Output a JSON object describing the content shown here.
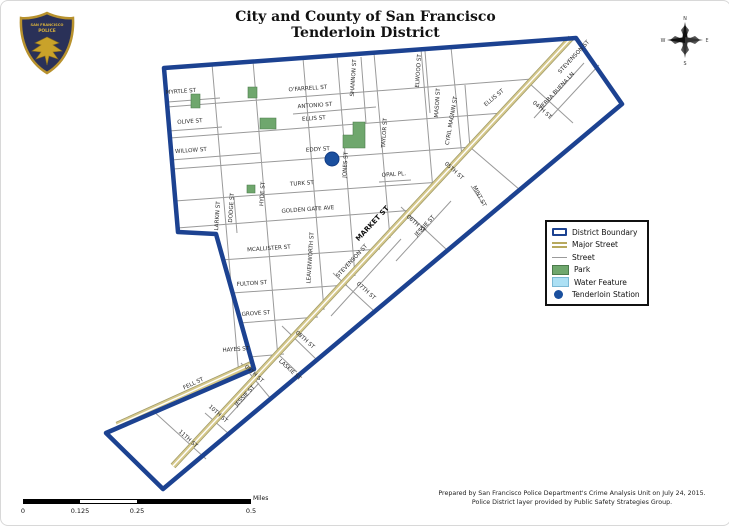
{
  "title": {
    "line1": "City and County of San Francisco",
    "line2": "Tenderloin District"
  },
  "badge": {
    "arc_top": "SAN FRANCISCO",
    "arc_middle": "POLICE"
  },
  "compass": {
    "n": "N",
    "e": "E",
    "s": "S",
    "w": "W"
  },
  "legend": {
    "items": [
      {
        "label": "District Boundary",
        "symbol": "district-boundary"
      },
      {
        "label": "Major Street",
        "symbol": "major-street"
      },
      {
        "label": "Street",
        "symbol": "street"
      },
      {
        "label": "Park",
        "symbol": "park"
      },
      {
        "label": "Water Feature",
        "symbol": "water-feature"
      },
      {
        "label": "Tenderloin Station",
        "symbol": "station-dot"
      }
    ]
  },
  "scale_bar": {
    "tick_labels": [
      "0",
      "0.125",
      "0.25",
      "0.5"
    ],
    "unit_label": "Miles"
  },
  "attribution": {
    "line1": "Prepared by San Francisco Police Department's Crime Analysis Unit on July 24, 2015.",
    "line2": "Police District layer provided by Public Safety Strategies Group."
  },
  "colors": {
    "boundary": "#1c4291",
    "major_street": "#d6c98c",
    "street": "#9a9a9a",
    "park": "#6fa76d",
    "water": "#ace0f4",
    "station": "#1a4f9e"
  },
  "map": {
    "street_labels": [
      {
        "t": "MYRTLE ST",
        "x": 180,
        "y": 92,
        "r": -4
      },
      {
        "t": "OLIVE ST",
        "x": 189,
        "y": 122,
        "r": -4
      },
      {
        "t": "WILLOW ST",
        "x": 190,
        "y": 151,
        "r": -4
      },
      {
        "t": "O'FARRELL ST",
        "x": 307,
        "y": 89,
        "r": -4
      },
      {
        "t": "ANTONIO ST",
        "x": 314,
        "y": 106,
        "r": -4
      },
      {
        "t": "ELLIS ST",
        "x": 313,
        "y": 119,
        "r": -4
      },
      {
        "t": "EDDY ST",
        "x": 317,
        "y": 150,
        "r": -4
      },
      {
        "t": "TURK ST",
        "x": 301,
        "y": 184,
        "r": -4
      },
      {
        "t": "OPAL PL.",
        "x": 393,
        "y": 175,
        "r": -4
      },
      {
        "t": "GOLDEN GATE AVE",
        "x": 307,
        "y": 210,
        "r": -4
      },
      {
        "t": "MCALLISTER ST",
        "x": 268,
        "y": 249,
        "r": -4
      },
      {
        "t": "FULTON ST",
        "x": 251,
        "y": 284,
        "r": -4
      },
      {
        "t": "GROVE ST",
        "x": 255,
        "y": 314,
        "r": -4
      },
      {
        "t": "HAYES ST",
        "x": 235,
        "y": 350,
        "r": -4
      },
      {
        "t": "ELLIS ST",
        "x": 494,
        "y": 98,
        "r": -40
      },
      {
        "t": "LARKIN ST",
        "x": 218,
        "y": 215,
        "r": -86
      },
      {
        "t": "DODGE ST",
        "x": 232,
        "y": 207,
        "r": -86
      },
      {
        "t": "HYDE ST",
        "x": 263,
        "y": 193,
        "r": -86
      },
      {
        "t": "LEAVENWORTH ST",
        "x": 311,
        "y": 257,
        "r": -86
      },
      {
        "t": "JONES ST",
        "x": 346,
        "y": 164,
        "r": -86
      },
      {
        "t": "TAYLOR ST",
        "x": 385,
        "y": 132,
        "r": -86
      },
      {
        "t": "SHANNON ST",
        "x": 354,
        "y": 77,
        "r": -86
      },
      {
        "t": "ELWOOD ST",
        "x": 419,
        "y": 70,
        "r": -86
      },
      {
        "t": "MASON ST",
        "x": 438,
        "y": 102,
        "r": -86
      },
      {
        "t": "CYRIL MAGNIN ST",
        "x": 452,
        "y": 120,
        "r": -80
      },
      {
        "t": "04TH ST",
        "x": 540,
        "y": 110,
        "r": 42
      },
      {
        "t": "05TH ST",
        "x": 452,
        "y": 171,
        "r": 42
      },
      {
        "t": "06TH ST",
        "x": 414,
        "y": 224,
        "r": 42
      },
      {
        "t": "07TH ST",
        "x": 364,
        "y": 291,
        "r": 42
      },
      {
        "t": "08TH ST",
        "x": 303,
        "y": 340,
        "r": 42
      },
      {
        "t": "09TH ST",
        "x": 252,
        "y": 374,
        "r": 42
      },
      {
        "t": "10TH ST",
        "x": 216,
        "y": 414,
        "r": 42
      },
      {
        "t": "11TH ST",
        "x": 186,
        "y": 439,
        "r": 42
      },
      {
        "t": "MINT ST",
        "x": 477,
        "y": 196,
        "r": 62
      },
      {
        "t": "LASKIE ST",
        "x": 288,
        "y": 370,
        "r": 42
      },
      {
        "t": "MARKET ST",
        "x": 373,
        "y": 224,
        "r": -47,
        "b": 1
      },
      {
        "t": "STEVENSON ST",
        "x": 352,
        "y": 261,
        "r": -47
      },
      {
        "t": "JESSIE ST",
        "x": 425,
        "y": 226,
        "r": -47
      },
      {
        "t": "JESSIE ST",
        "x": 245,
        "y": 396,
        "r": -47
      },
      {
        "t": "STEVENSON ST",
        "x": 574,
        "y": 57,
        "r": -47
      },
      {
        "t": "YERBA BUENA LN",
        "x": 557,
        "y": 91,
        "r": -47
      },
      {
        "t": "FELL ST",
        "x": 193,
        "y": 384,
        "r": -25
      }
    ]
  }
}
